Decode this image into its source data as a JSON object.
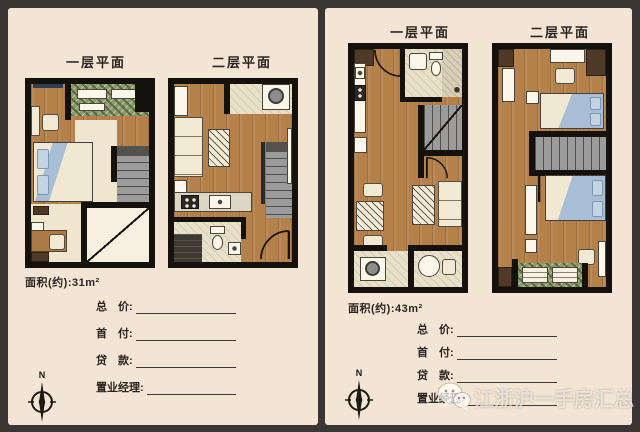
{
  "colors": {
    "frame": "#3a3633",
    "panel": "#f3e5d3",
    "wall": "#15110c",
    "wood_floor": "#b5814b",
    "bed_blue": "#a7bed4",
    "stairs_gray": "#9b9b9b",
    "balcony_green": "#8a9a6c",
    "tile": "#e9e0c8",
    "text": "#2a2521"
  },
  "left_flyer": {
    "floor1_title": "一层平面",
    "floor2_title": "二层平面",
    "area_label": "面积(约):31m²",
    "compass_n": "N"
  },
  "right_flyer": {
    "floor1_title": "一层平面",
    "floor2_title": "二层平面",
    "area_label": "面积(约):43m²",
    "compass_n": "N"
  },
  "fields": [
    {
      "label": "总　价:"
    },
    {
      "label": "首　付:"
    },
    {
      "label": "贷　款:"
    },
    {
      "label": "置业经理:"
    }
  ],
  "watermark": {
    "icon": "wechat-logo",
    "text": "江浙沪一手房汇总"
  }
}
